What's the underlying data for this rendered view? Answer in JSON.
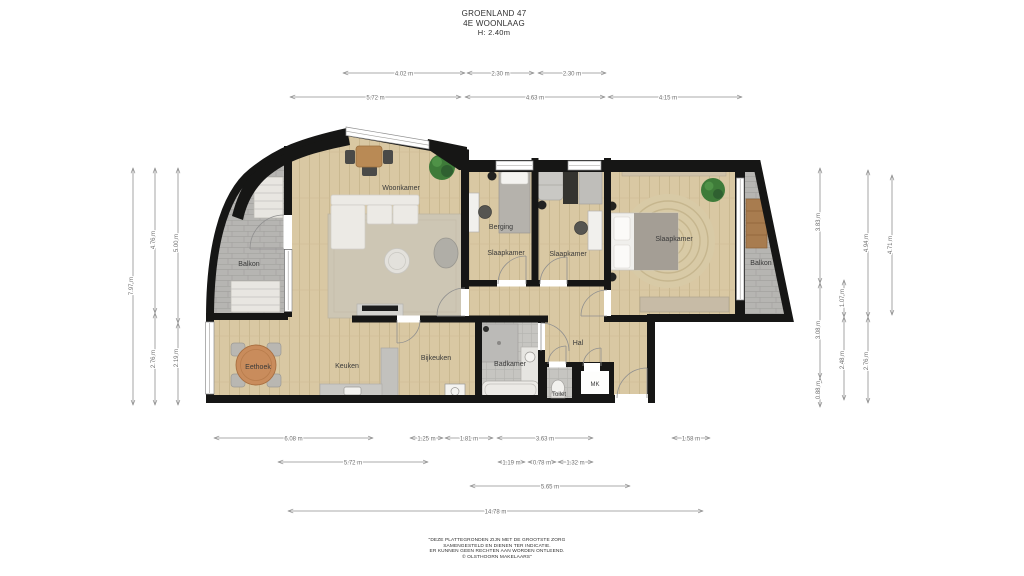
{
  "title": {
    "address": "GROENLAND 47",
    "floor": "4E WOONLAAG",
    "ceiling_height": "H: 2.40m"
  },
  "rooms": {
    "woonkamer": "Woonkamer",
    "balkon_left": "Balkon",
    "balkon_right": "Balkon",
    "berging": "Berging",
    "slaapkamer_1": "Slaapkamer",
    "slaapkamer_2": "Slaapkamer",
    "slaapkamer_3": "Slaapkamer",
    "eethoek": "Eethoek",
    "keuken": "Keuken",
    "bijkeuken": "Bijkeuken",
    "badkamer": "Badkamer",
    "hal": "Hal",
    "toilet": "Toilet",
    "mk": "MK"
  },
  "dimensions": {
    "top_row1": [
      "4.02 m",
      "2.30 m",
      "2.30 m"
    ],
    "top_row2": [
      "5.72 m",
      "4.63 m",
      "4.15 m"
    ],
    "bottom_row1": [
      "6.08 m",
      "1.25 m",
      "1.81 m",
      "3.63 m",
      "1.58 m"
    ],
    "bottom_row2": [
      "5.72 m",
      "1.19 m",
      "0.78 m",
      "1.32 m"
    ],
    "bottom_row3": [
      "5.65 m"
    ],
    "bottom_row4": [
      "14.78 m"
    ],
    "left_col1": [
      "7.97 m"
    ],
    "left_col2": [
      "4.76 m",
      "2.76 m"
    ],
    "left_col3": [
      "5.00 m",
      "2.19 m"
    ],
    "right_col1": [
      "3.83 m",
      "3.08 m",
      "0.88 m"
    ],
    "right_col2": [
      "1.07 m",
      "2.48 m"
    ],
    "right_col3": [
      "4.94 m",
      "2.76 m"
    ],
    "right_col4": [
      "4.71 m"
    ]
  },
  "disclaimer": {
    "line1": "\"DEZE PLATTEGRONDEN ZIJN MET DE GROOTSTE ZORG",
    "line2": "SAMENGESTELD EN DIENEN TER INDICATIE.",
    "line3": "ER KUNNEN GEEN RECHTEN AAN WORDEN ONTLEEND.",
    "line4": "© OLSTHOORN MAKELAARS\""
  },
  "colors": {
    "wall": "#161615",
    "wood_floor": "#d9c8a3",
    "balcony_tile": "#b6b5b2",
    "bath_tile": "#c6c5c1",
    "dimension_line": "#8f8f8f",
    "label_text": "#3a3a3a",
    "plant_green": "#3e7b39",
    "table_wood": "#c98c5c"
  }
}
